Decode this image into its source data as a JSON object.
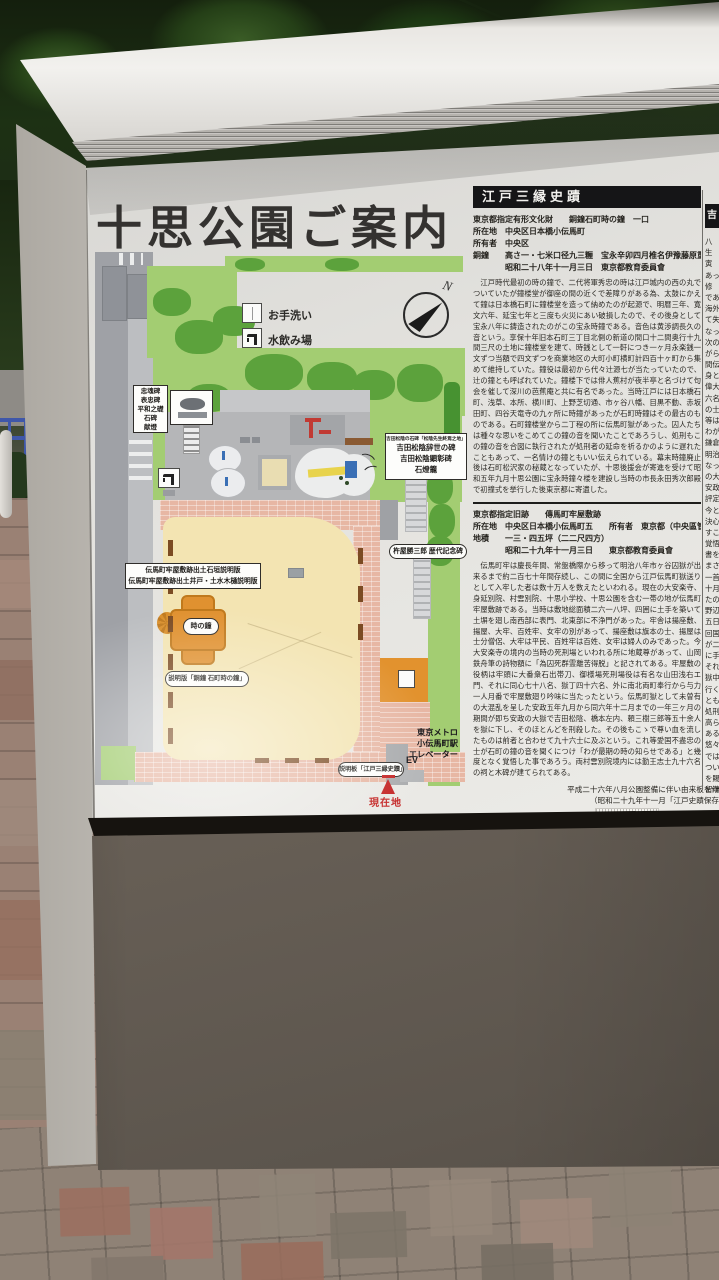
{
  "sign": {
    "title": "十思公園ご案内",
    "legend": {
      "toilet_label": "お手洗い",
      "fountain_label": "水飲み場"
    },
    "compass_n": "N",
    "map": {
      "monument_lines": [
        "忠魂碑",
        "表忠碑",
        "平和之礎",
        "石碑",
        "献燈"
      ],
      "yoshida_line1": "吉田松陰の石碑「松陰先生終焉之地」",
      "yoshida_line2": "吉田松陰辞世の碑",
      "yoshida_line3": "吉田松陰顕彰碑",
      "yoshida_line4": "石燈籠",
      "kineya_label": "杵屋勝三郎 歴代記念碑",
      "denma_lines": [
        "伝馬町牢屋敷跡出土石垣説明版",
        "伝馬町牢屋敷跡出土井戸・土水木樋説明版"
      ],
      "bell_label": "時の鐘",
      "bell_plate_label": "説明版「銅鐘 石町時の鐘」",
      "metro_lines": [
        "東京メトロ",
        "小伝馬町駅",
        "エレベーター"
      ],
      "ev_label": "EV",
      "edo_plate_label": "説明板「江戸三縁史蹟」",
      "current_location": "現在地"
    },
    "panel": {
      "header": "江戸三縁史蹟",
      "section1": {
        "title_line": "東京都指定有形文化財　　銅鐘石町時の鐘　一口",
        "meta": [
          "所在地　中央区日本橋小伝馬町",
          "所有者　中央区",
          "銅鐘　　高さ一・七米口径九三糎　宝永辛卯四月椎名伊豫藤原重体",
          "　　　　昭和二十八年十一月三日　東京都教育委員會"
        ],
        "body": "　江戸時代最初の時の鐘で、二代将軍秀忠の時は江戸城内の西の丸でついていたが鐘楼堂が御座の間の近くで差障りがある為、太鼓にかえて鐘は日本橋石町に鐘楼堂を造って納めたのが起源で、明暦三年、寛文六年、延宝七年と三度も火災にあい破損したので、その後身として宝永八年に鋳造されたのがこの宝永時鐘である。音色は黄渉調長久の音という。享保十年旧本石町三丁目北側の新道の間口十二間奥行十九間三尺の土地に鐘楼堂を建て、時銭として一軒につき一ヶ月永楽銭一文ずつ当額で四文ずつを商業地区の大町小町横町計四百十ヶ町から集めて維持していた。鐘役は最初から代々辻源七が当たっていたので、辻の鐘とも呼ばれていた。鐘楼下では俳人蕉村が夜半亭と名づけて句会を催して深川の芭蕉庵と共に有名であった。当時江戸には日本橋石町、浅草、本所、横川町、上野芝切通、市ヶ谷八幡、目黒不動、赤坂田町、四谷天竜寺の九ヶ所に時鐘があったが石町時鐘はその最古のものである。石町鐘楼堂から二丁程の所に伝馬町獄があった。囚人たちは種々な思いをこめてこの鐘の音を聞いたことであろうし、処刑もこの鐘の音を合図に執行されたが処刑者の延命を祈るかのように遅れたこともあって、一名情けの鐘ともいい伝えられている。幕末時鐘廃止後は石町松沢家の秘蔵となっていたが、十思後援会が寄進を受けて昭和五年九月十思公園に宝永時鐘々楼を建設し当時の市長永田秀次郎殿で初撞式を挙行した後東京都に寄遺した。"
      },
      "section2": {
        "title_line": "東京都指定旧跡　　傳馬町牢屋敷跡",
        "meta": [
          "所在地　中央区日本橋小伝馬町五　　所有者　東京都（中央區管理）",
          "地積　　一三・四五坪（二二尺四方）",
          "　　　　昭和二十九年十一月三日　　東京都教育委員會"
        ],
        "body": "　伝馬町牢は慶長年間、常盤橋際から移って明治八年市ヶ谷囚獄が出来るまで約二百七十年間存続し、この間に全国から江戸伝馬町獄送りとして入牢した者は数十万人を数えたといわれる。現在の大安楽寺、身延別院、村雲別院、十思小学校、十思公園を含む一帯の地が伝馬町牢屋敷跡である。当時は敷地総面積二六一八坪、四囲に土手を築いて土塀を廻し南西部に表門、北東部に不浄門があった。牢舎は揚座敷、揚屋、大牢、百姓牢、女牢の別があって、揚座敷は旗本の士、揚屋は士分僧侶、大牢は平民、百姓牢は百姓、女牢は婦人のみであった。今大安楽寺の境内の当時の死刑場といわれる所に地蔵尊があって、山岡鉄舟筆の詩物額に「為囚死群霊離苦得脱」と記されてある。牢屋敷の役柄は牢頭に大番衆石出帯刀、御様場死刑場役は有名な山田浅右エ門、それに同心七十八名、獄丁四十六名、外に南北両町奉行から与力一人月番で牢屋敷廻り吟味に当たったという。伝馬町獄として未曽有の大混乱を呈した安政五年九月から同六年十二月までの一年三ヶ月の期間が即ち安政の大獄で吉田松陰、橋本左内、頼三樹三郎等五十余人を獄に下し、そのほとんどを刑殺した。その後もこゝで尊い血を流したものは前者と合わせて九十六士に及ぶという。これ等愛国不盡忠の士が石町の鐘の音を聞くにつけ「わが最期の時の知らせである」と幾度となく覚悟した事であろう。両村雲別院境内には勤王志士九十六名の祠と木碑が建てられてある。"
      },
      "footnote1": "平成二十六年八月公園整備に伴い由来板を作",
      "footnote2": "（昭和二十九年十一月「江戸史蹟保存",
      "column2_header": "吉",
      "column2_fragments": [
        "八",
        "生",
        "寅",
        "あっ",
        "修",
        "であ",
        "海外",
        "て失",
        "なっ",
        "次の",
        "がら",
        "間伝",
        "身と",
        "偉大",
        "六名",
        "の士",
        "等は",
        "わが国",
        "鎌倉幕",
        "明治維",
        "なったこ",
        "の大獄",
        "安政六",
        "評定所",
        "今とて",
        "決心を",
        "すこと",
        "覚悟し",
        "書を送",
        "まさる",
        "一首で",
        "十月廿",
        "たのが",
        "野辺に",
        "五日",
        "回国で",
        "が二十",
        "に手渡",
        "それに",
        "獄中の",
        "行くべ",
        "ともい",
        "処刑の",
        "高らか",
        "ある。",
        "悠々た",
        "では「",
        "ついた",
        "を賜任",
        "留魂碑"
      ]
    },
    "colors": {
      "map_green": "#a3cd72",
      "map_green_dark": "#5ca23c",
      "plaza_tan": "#f3e4b2",
      "brick_pink": "#e7b7a4",
      "structure_orange": "#e2922e",
      "accent_red": "#c32222"
    }
  }
}
